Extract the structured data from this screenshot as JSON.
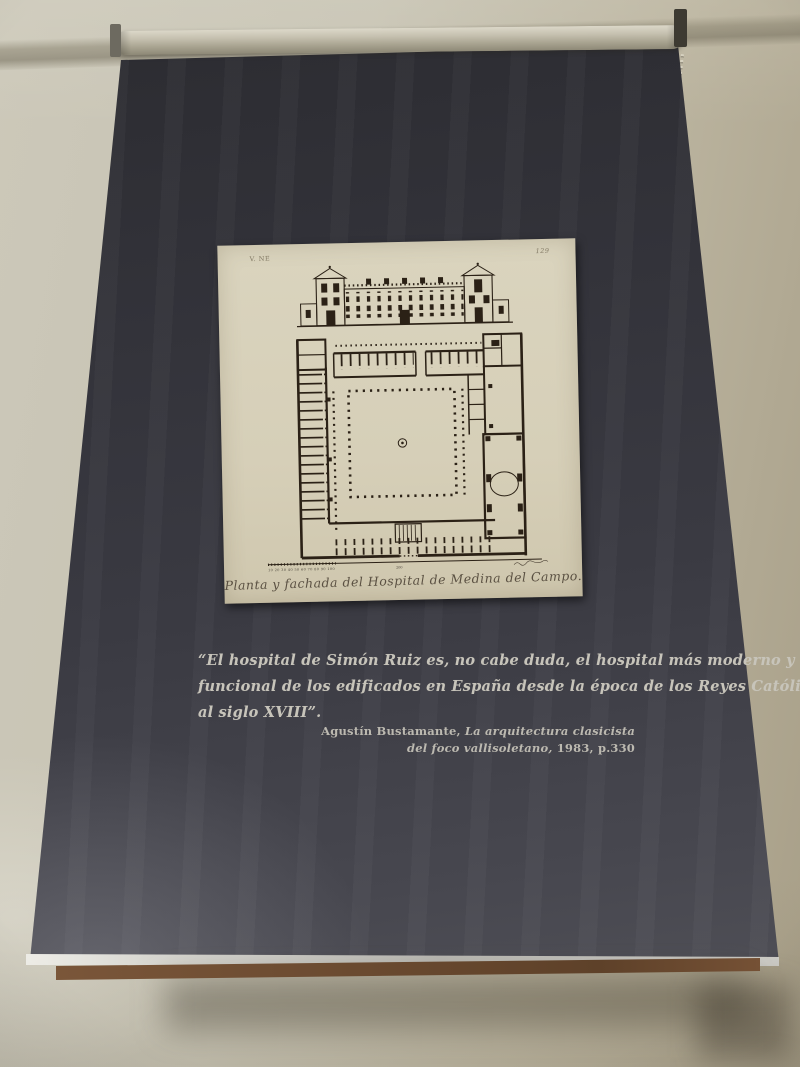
{
  "colors": {
    "wall": "#c7c3b3",
    "banner_dark": "#323239",
    "paper": "#d8d2bc",
    "ink": "#2b2116",
    "wood_batten": "#6a4a30",
    "quote_text": "#c7c4ba"
  },
  "print": {
    "plate_mark_left": "V. NE",
    "plate_number_right": "129",
    "caption": "Planta y fachada del Hospital de Medina del Campo.",
    "scale": {
      "left_numbers": "10 20 30 40 50 60 70 80 90 100",
      "middle_number": "200"
    }
  },
  "quote": {
    "lines": [
      "“El hospital de Simón Ruiz es, no cabe duda, el hospital más moderno y",
      "funcional de los edificados en España desde la época de los Reyes Católicos",
      "al siglo XVIII”."
    ],
    "attribution": {
      "author": "Agustín Bustamante, ",
      "work_line1": "La arquitectura clasicista",
      "work_line2": "del foco vallisoletano,",
      "detail": " 1983, p.330"
    }
  }
}
